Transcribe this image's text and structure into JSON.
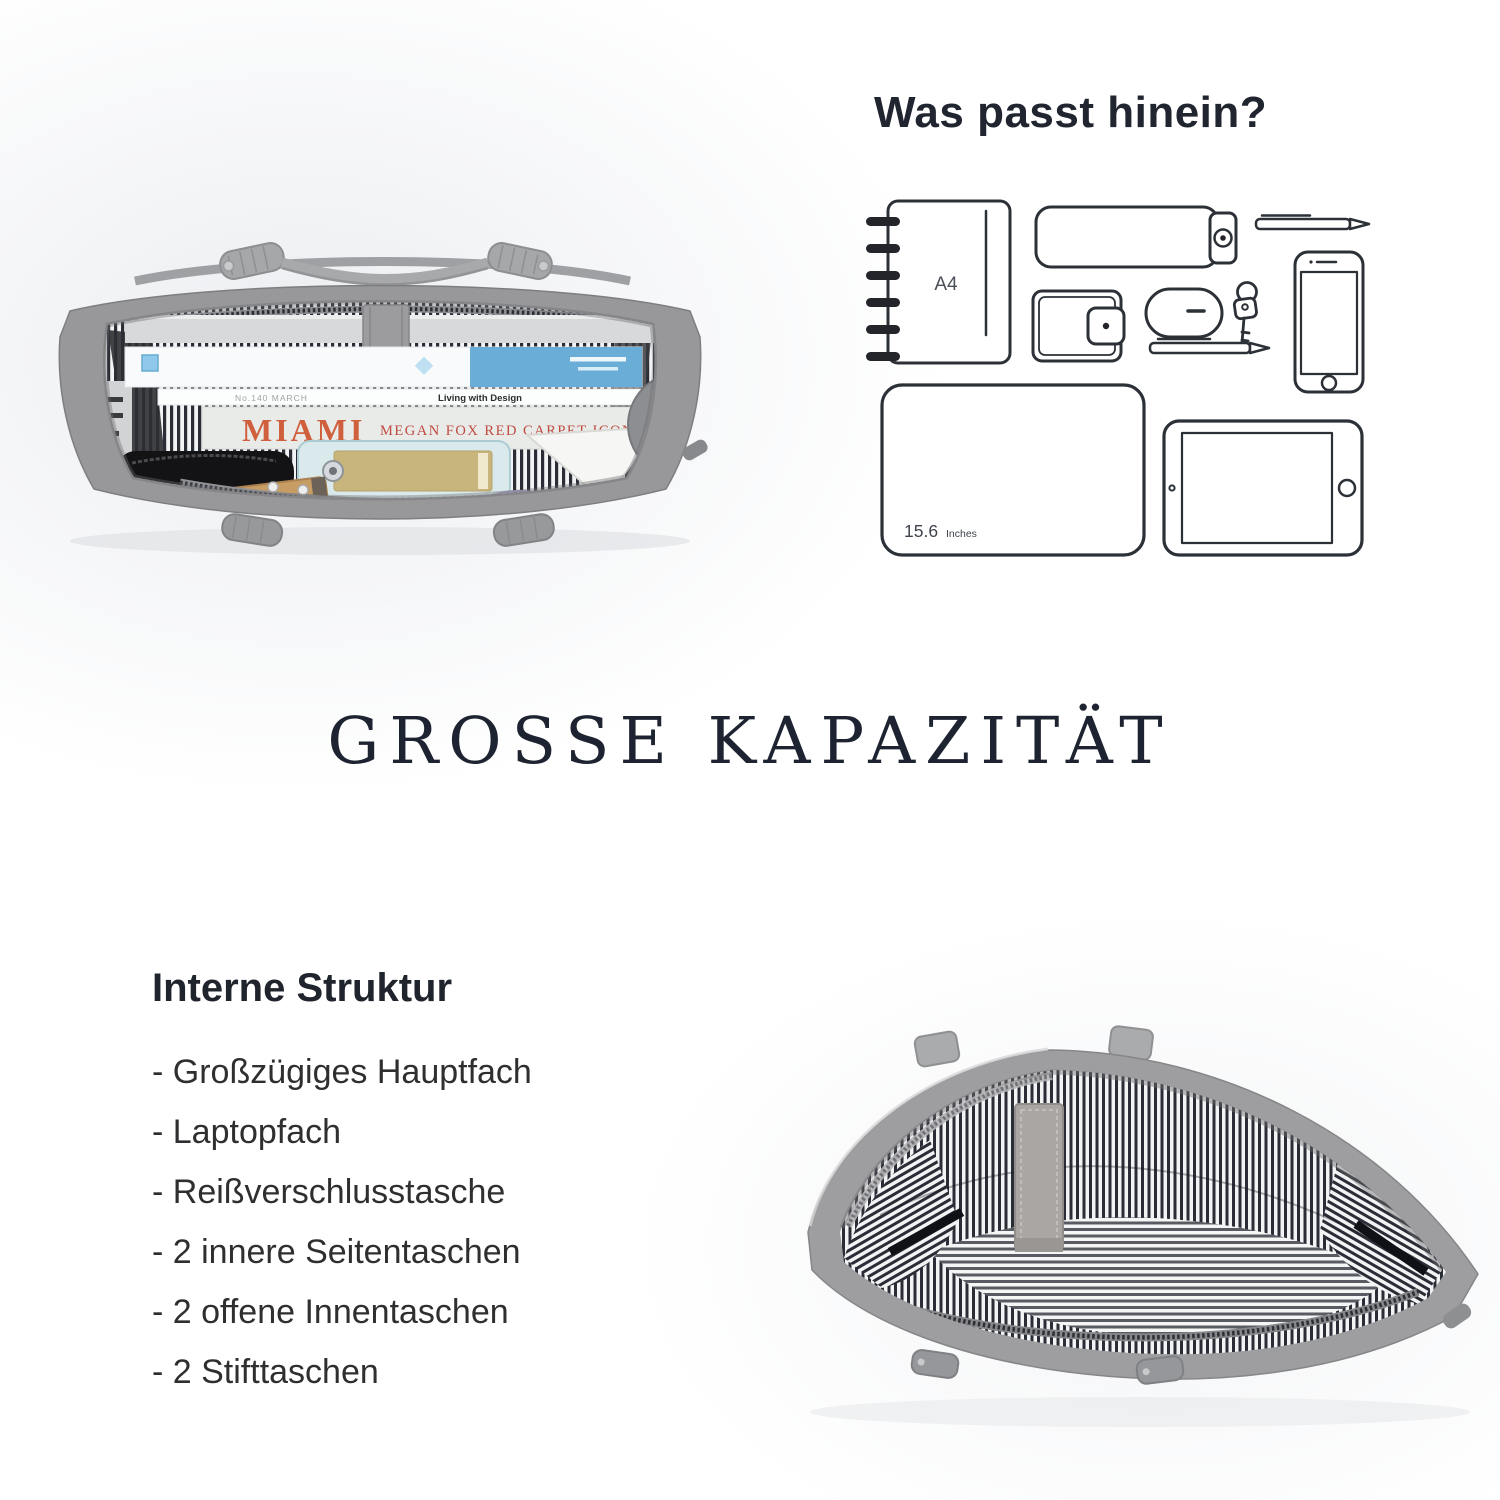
{
  "what_fits": {
    "heading": "Was passt hinein?",
    "a4_label": "A4",
    "laptop_size": "15.6",
    "laptop_unit": "Inches"
  },
  "banner": {
    "title": "GROSSE KAPAZITÄT"
  },
  "internal_structure": {
    "heading": "Interne Struktur",
    "items": [
      "- Großzügiges Hauptfach",
      "- Laptopfach",
      "- Reißverschlusstasche",
      "- 2 innere Seitentaschen",
      "- 2 offene Innentaschen",
      "- 2 Stifttaschen"
    ]
  },
  "packed_bag_photo": {
    "miami_title": "MIAMI",
    "miami_subtitle": "MEGAN FOX RED CARPET ICON",
    "magazine_spine": "Living with Design",
    "magazine_issue": "No.140 MARCH",
    "cork_label": "H.GravurePrint"
  },
  "colors": {
    "heading_text": "#20252f",
    "title_text": "#1d2331",
    "body_text": "#2f2f31",
    "line_art": "#2c3037",
    "bag_gray": "#98989a",
    "stripe_navy": "#2a2d36",
    "miami_orange": "#cf5f3d",
    "miami_red": "#bf4a40",
    "book_blue": "#6aaed8",
    "mint": "#d9e9ec",
    "gold": "#c8b57c",
    "purple": "#a9a3c9",
    "cork": "#c89d64"
  }
}
